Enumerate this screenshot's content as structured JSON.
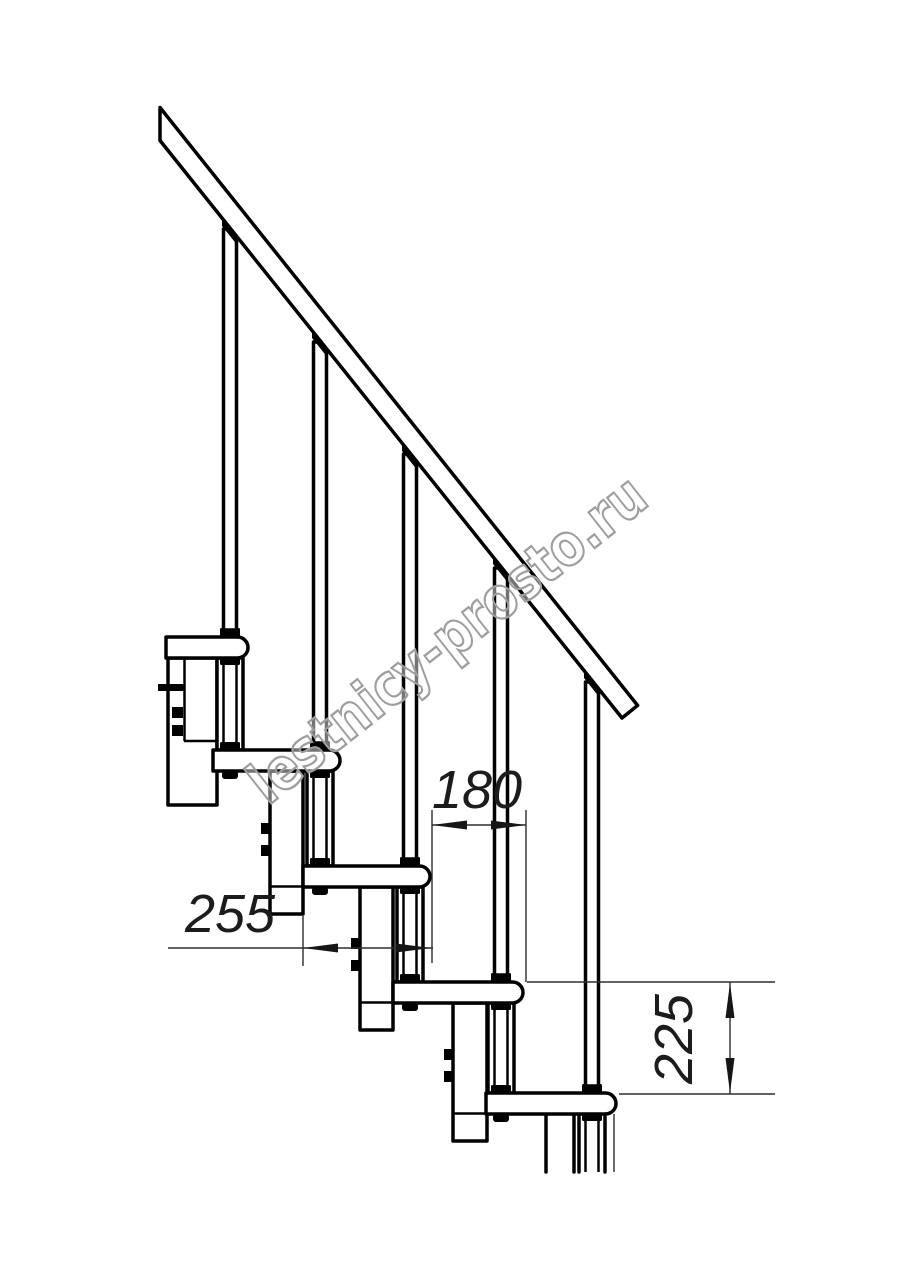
{
  "title": "Modular staircase side-view technical drawing",
  "watermark": {
    "text": "lestnicy-prosto.ru"
  },
  "dimensions": {
    "tread_depth_label": "255",
    "going_label": "180",
    "rise_label": "225"
  },
  "colors": {
    "line": "#000000",
    "dim_line": "#2e2e2e",
    "dim_text": "#1c1c1c",
    "watermark_stroke": "#9e9e9e",
    "background": "#ffffff"
  }
}
